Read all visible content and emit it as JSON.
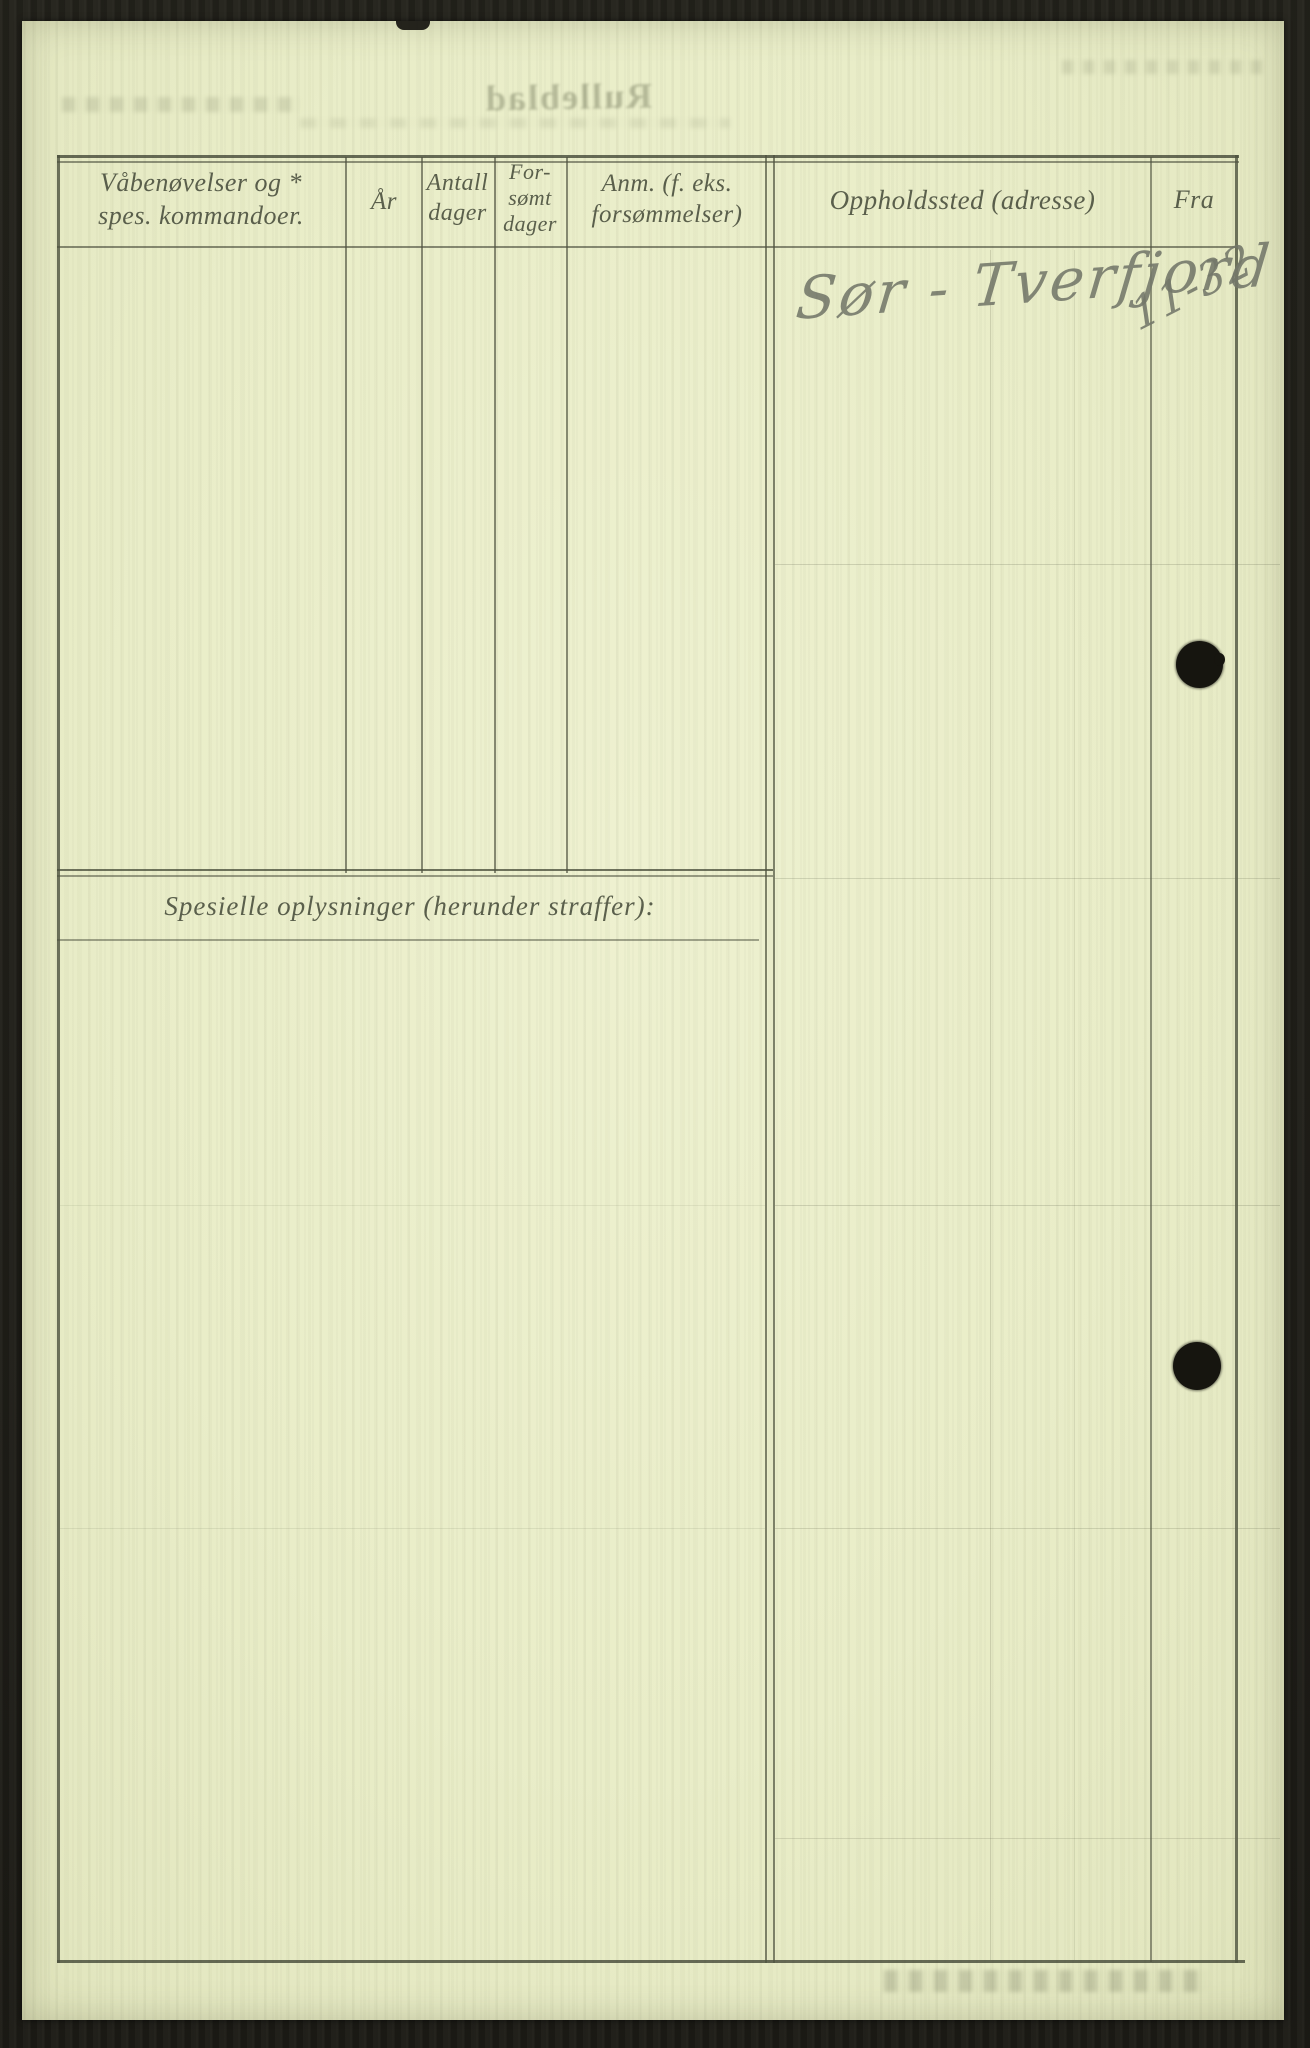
{
  "document": {
    "kind": "scanned archival service-record form (Rulleblad)",
    "bleedthrough": {
      "title": "Rulleblad"
    },
    "table": {
      "headers": {
        "col1_line1": "Våbenøvelser og *",
        "col1_line2": "spes. kommandoer.",
        "col2": "År",
        "col3_line1": "Antall",
        "col3_line2": "dager",
        "col4_line1": "For-",
        "col4_line2": "sømt",
        "col4_line3": "dager",
        "col5_line1": "Anm. (f. eks.",
        "col5_line2": "forsømmelser)",
        "col6": "Oppholdssted (adresse)",
        "col7": "Fra"
      },
      "entry": {
        "oppholdssted": "Sør - Tverfjord",
        "fra": "11-32"
      }
    },
    "section_label": "Spesielle oplysninger (herunder straffer):",
    "colors": {
      "paper": "#e9edc8",
      "rule_ink": "#4e523f",
      "header_ink": "#4f5442",
      "handwriting_ink": "#74786a",
      "punch_hole": "#16150f",
      "scan_background": "#21201a"
    }
  }
}
